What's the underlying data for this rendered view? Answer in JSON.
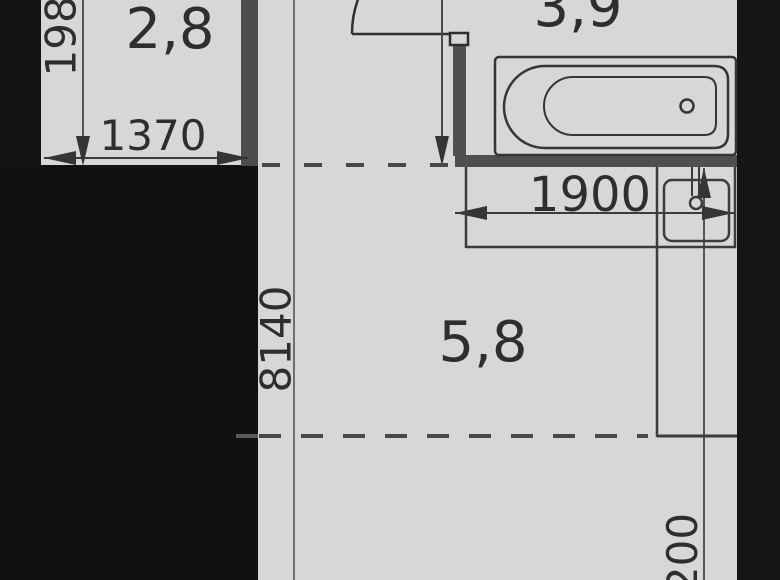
{
  "plan": {
    "type": "apartment-floor-plan",
    "rooms": [
      {
        "id": "hall",
        "area_label": "2,8"
      },
      {
        "id": "bathroom",
        "area_label": "3,9"
      },
      {
        "id": "kitchen",
        "area_label": "5,8"
      }
    ],
    "dimensions": {
      "hall_width": "1370",
      "hall_depth": "1980",
      "counter_width": "1900",
      "room_length": "8140",
      "right_partial": "200"
    },
    "fixtures": [
      "bathtub",
      "sink",
      "door-swing"
    ],
    "colors": {
      "background": "#d7d7d7",
      "outer_wall": "#131313",
      "inner_wall": "#4d4d4d",
      "line": "#3c3c3c",
      "text": "#2e2e2e"
    }
  }
}
